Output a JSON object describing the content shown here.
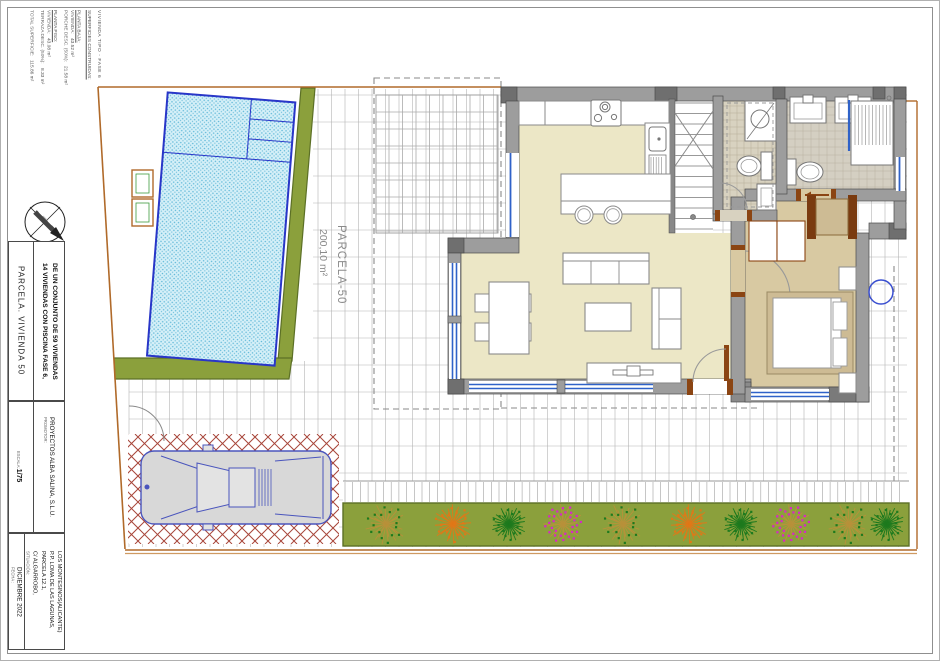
{
  "title_block": {
    "doc_type": "VIVIENDA TIPO - FASE 6",
    "surfaces": {
      "header": "SUPERFICIES CONSTRUIDAS:",
      "groups": [
        {
          "title": "PLANTA BAJA:",
          "rows": [
            {
              "label": "VIVIENDA:",
              "value": "43.52 m²"
            },
            {
              "label": "PORCHE DESC. (50%):",
              "value": "21.58 m²"
            }
          ]
        },
        {
          "title": "PLANTA PISO:",
          "rows": [
            {
              "label": "VIVIENDA:",
              "value": "43.08 m²"
            },
            {
              "label": "TERRAZA DESC. (50%):",
              "value": "8.33 m²"
            }
          ]
        }
      ],
      "total_label": "TOTAL SUPERFICIE:",
      "total_value": "115.86 m²"
    },
    "parcel_title": "PARCELA. VIVIENDA 50",
    "project_title_line1": "14 VIVIENDAS CON PISCINA FASE 6,",
    "project_title_line2": "DE UN CONJUNTO DE 59 VIVIENDAS",
    "promoter_label": "PROMOTOR:",
    "promoter": "PROYECTOS ALBA SALINA, S.L.U.",
    "scale_label": "ESCALA:",
    "scale": "1/75",
    "location_label": "SITUACIÓN:",
    "location_lines": [
      "C/ ALGARROBO,",
      "PARCELA 12.1,",
      "P.P. LOMA DE LAS LAGUNAS,",
      "LOS MONTESINOS(ALICANTE)"
    ],
    "date_label": "FECHA :",
    "date": "DICIEMBRE 2022",
    "north_label": "N"
  },
  "plan": {
    "parcel_label": "PARCELA-50",
    "parcel_area": "200,10 m²"
  },
  "colors": {
    "pool_water": "#d6f0f8",
    "pool_dot": "#5fb8d8",
    "pool_line": "#2936c8",
    "wall": "#9d9d9d",
    "wall_dark": "#6f6f6f",
    "wall_edge": "#4a4a4a",
    "floor_living": "#ece7c6",
    "floor_bedroom": "#d8c9a2",
    "floor_bath1": "#d8d2c0",
    "floor_bath2": "#d4cfc2",
    "tile_line": "#b5ad98",
    "green": "#8ba03c",
    "green_edge": "#5c7026",
    "boundary": "#b06a2a",
    "boundary_light": "#cf9a62",
    "hatch": "#a8463a",
    "car": "#4a55bd",
    "car_fill": "#d8d8d8",
    "window": "#2f62c8",
    "grid": "#b4b4b4",
    "door_wood": "#8b4513",
    "plant_olive": "#b8913a",
    "plant_orange": "#e07818",
    "plant_green": "#1e7a1e",
    "plant_magenta": "#d628c8"
  }
}
